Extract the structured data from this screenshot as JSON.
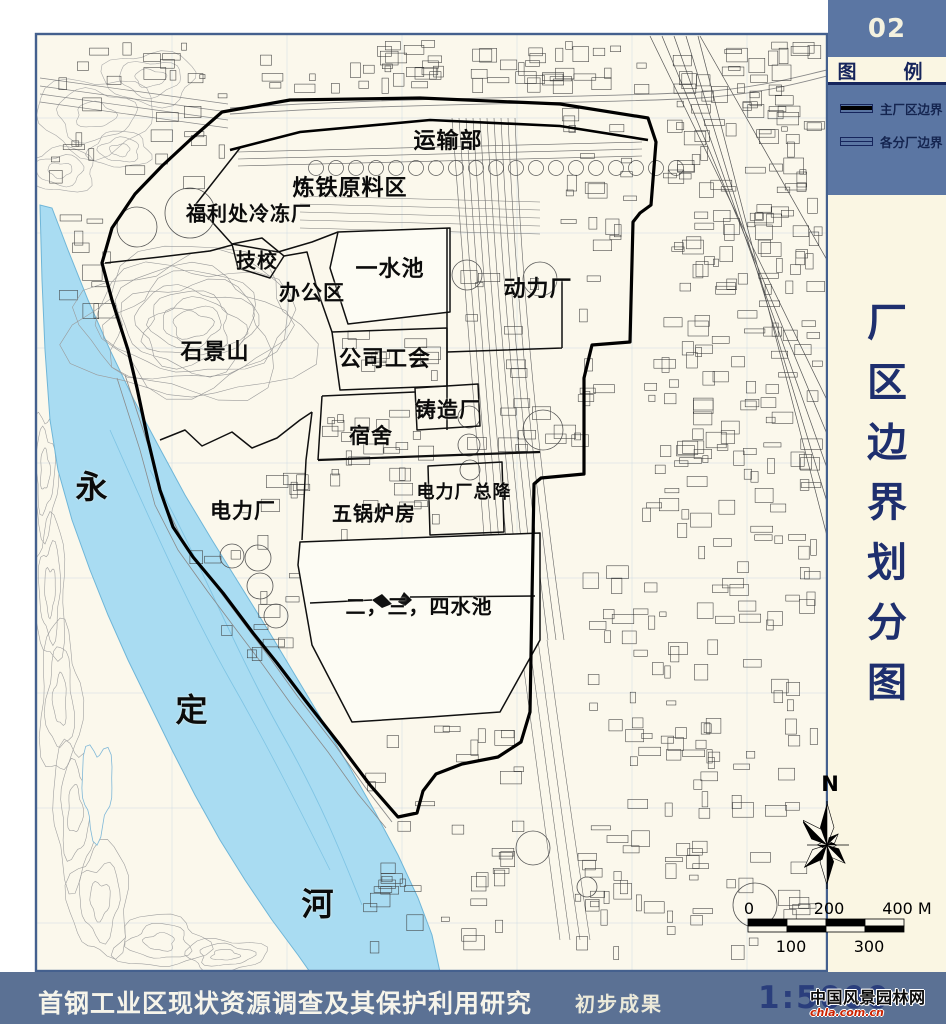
{
  "colors": {
    "sidebar_blue": "#5b76a3",
    "bottom_bar_blue": "#5b7194",
    "cream": "#faf6e3",
    "map_cream": "#fbf8ec",
    "river_blue": "#a9dcf2",
    "navy_text": "#1e2f6e",
    "boundary_black": "#000000"
  },
  "sidebar": {
    "page_code": "02",
    "legend_title": "图　例",
    "legend_items": [
      {
        "label": "主厂区边界",
        "swatch": "main"
      },
      {
        "label": "各分厂边界",
        "swatch": "sub"
      }
    ],
    "map_title": "厂区边界划分图"
  },
  "map": {
    "north_label": "N",
    "labels": [
      {
        "text": "运输部",
        "x": 448,
        "y": 139,
        "size": 22
      },
      {
        "text": "炼铁原料区",
        "x": 350,
        "y": 186,
        "size": 22
      },
      {
        "text": "福利处冷冻厂",
        "x": 249,
        "y": 212,
        "size": 20
      },
      {
        "text": "技校",
        "x": 257,
        "y": 259,
        "size": 20
      },
      {
        "text": "办公区",
        "x": 312,
        "y": 292,
        "size": 21
      },
      {
        "text": "一水池",
        "x": 390,
        "y": 267,
        "size": 22
      },
      {
        "text": "动力厂",
        "x": 538,
        "y": 287,
        "size": 22
      },
      {
        "text": "石景山",
        "x": 215,
        "y": 350,
        "size": 22
      },
      {
        "text": "公司工会",
        "x": 385,
        "y": 357,
        "size": 22
      },
      {
        "text": "铸造厂",
        "x": 448,
        "y": 409,
        "size": 21
      },
      {
        "text": "宿舍",
        "x": 371,
        "y": 435,
        "size": 21
      },
      {
        "text": "电力厂总降",
        "x": 464,
        "y": 491,
        "size": 18
      },
      {
        "text": "电力厂",
        "x": 243,
        "y": 510,
        "size": 21
      },
      {
        "text": "五锅炉房",
        "x": 374,
        "y": 512,
        "size": 20
      },
      {
        "text": "二，三，四水池",
        "x": 419,
        "y": 605,
        "size": 20
      },
      {
        "text": "永",
        "x": 92,
        "y": 485,
        "size": 32
      },
      {
        "text": "定",
        "x": 192,
        "y": 708,
        "size": 32
      },
      {
        "text": "河",
        "x": 318,
        "y": 902,
        "size": 32
      }
    ]
  },
  "scalebar": {
    "top_labels": [
      {
        "text": "0",
        "x": 14,
        "y": 6
      },
      {
        "text": "200",
        "x": 94,
        "y": 6
      },
      {
        "text": "400 M",
        "x": 172,
        "y": 6
      }
    ],
    "bottom_labels": [
      {
        "text": "100",
        "x": 56,
        "y": 44
      },
      {
        "text": "300",
        "x": 134,
        "y": 44
      }
    ]
  },
  "footer": {
    "project_title": "首钢工业区现状资源调查及其保护利用研究",
    "status": "初步成果",
    "scale": "1:5000"
  },
  "watermark": {
    "line1": "中国风景园林网",
    "line2": "chla.com.cn"
  }
}
